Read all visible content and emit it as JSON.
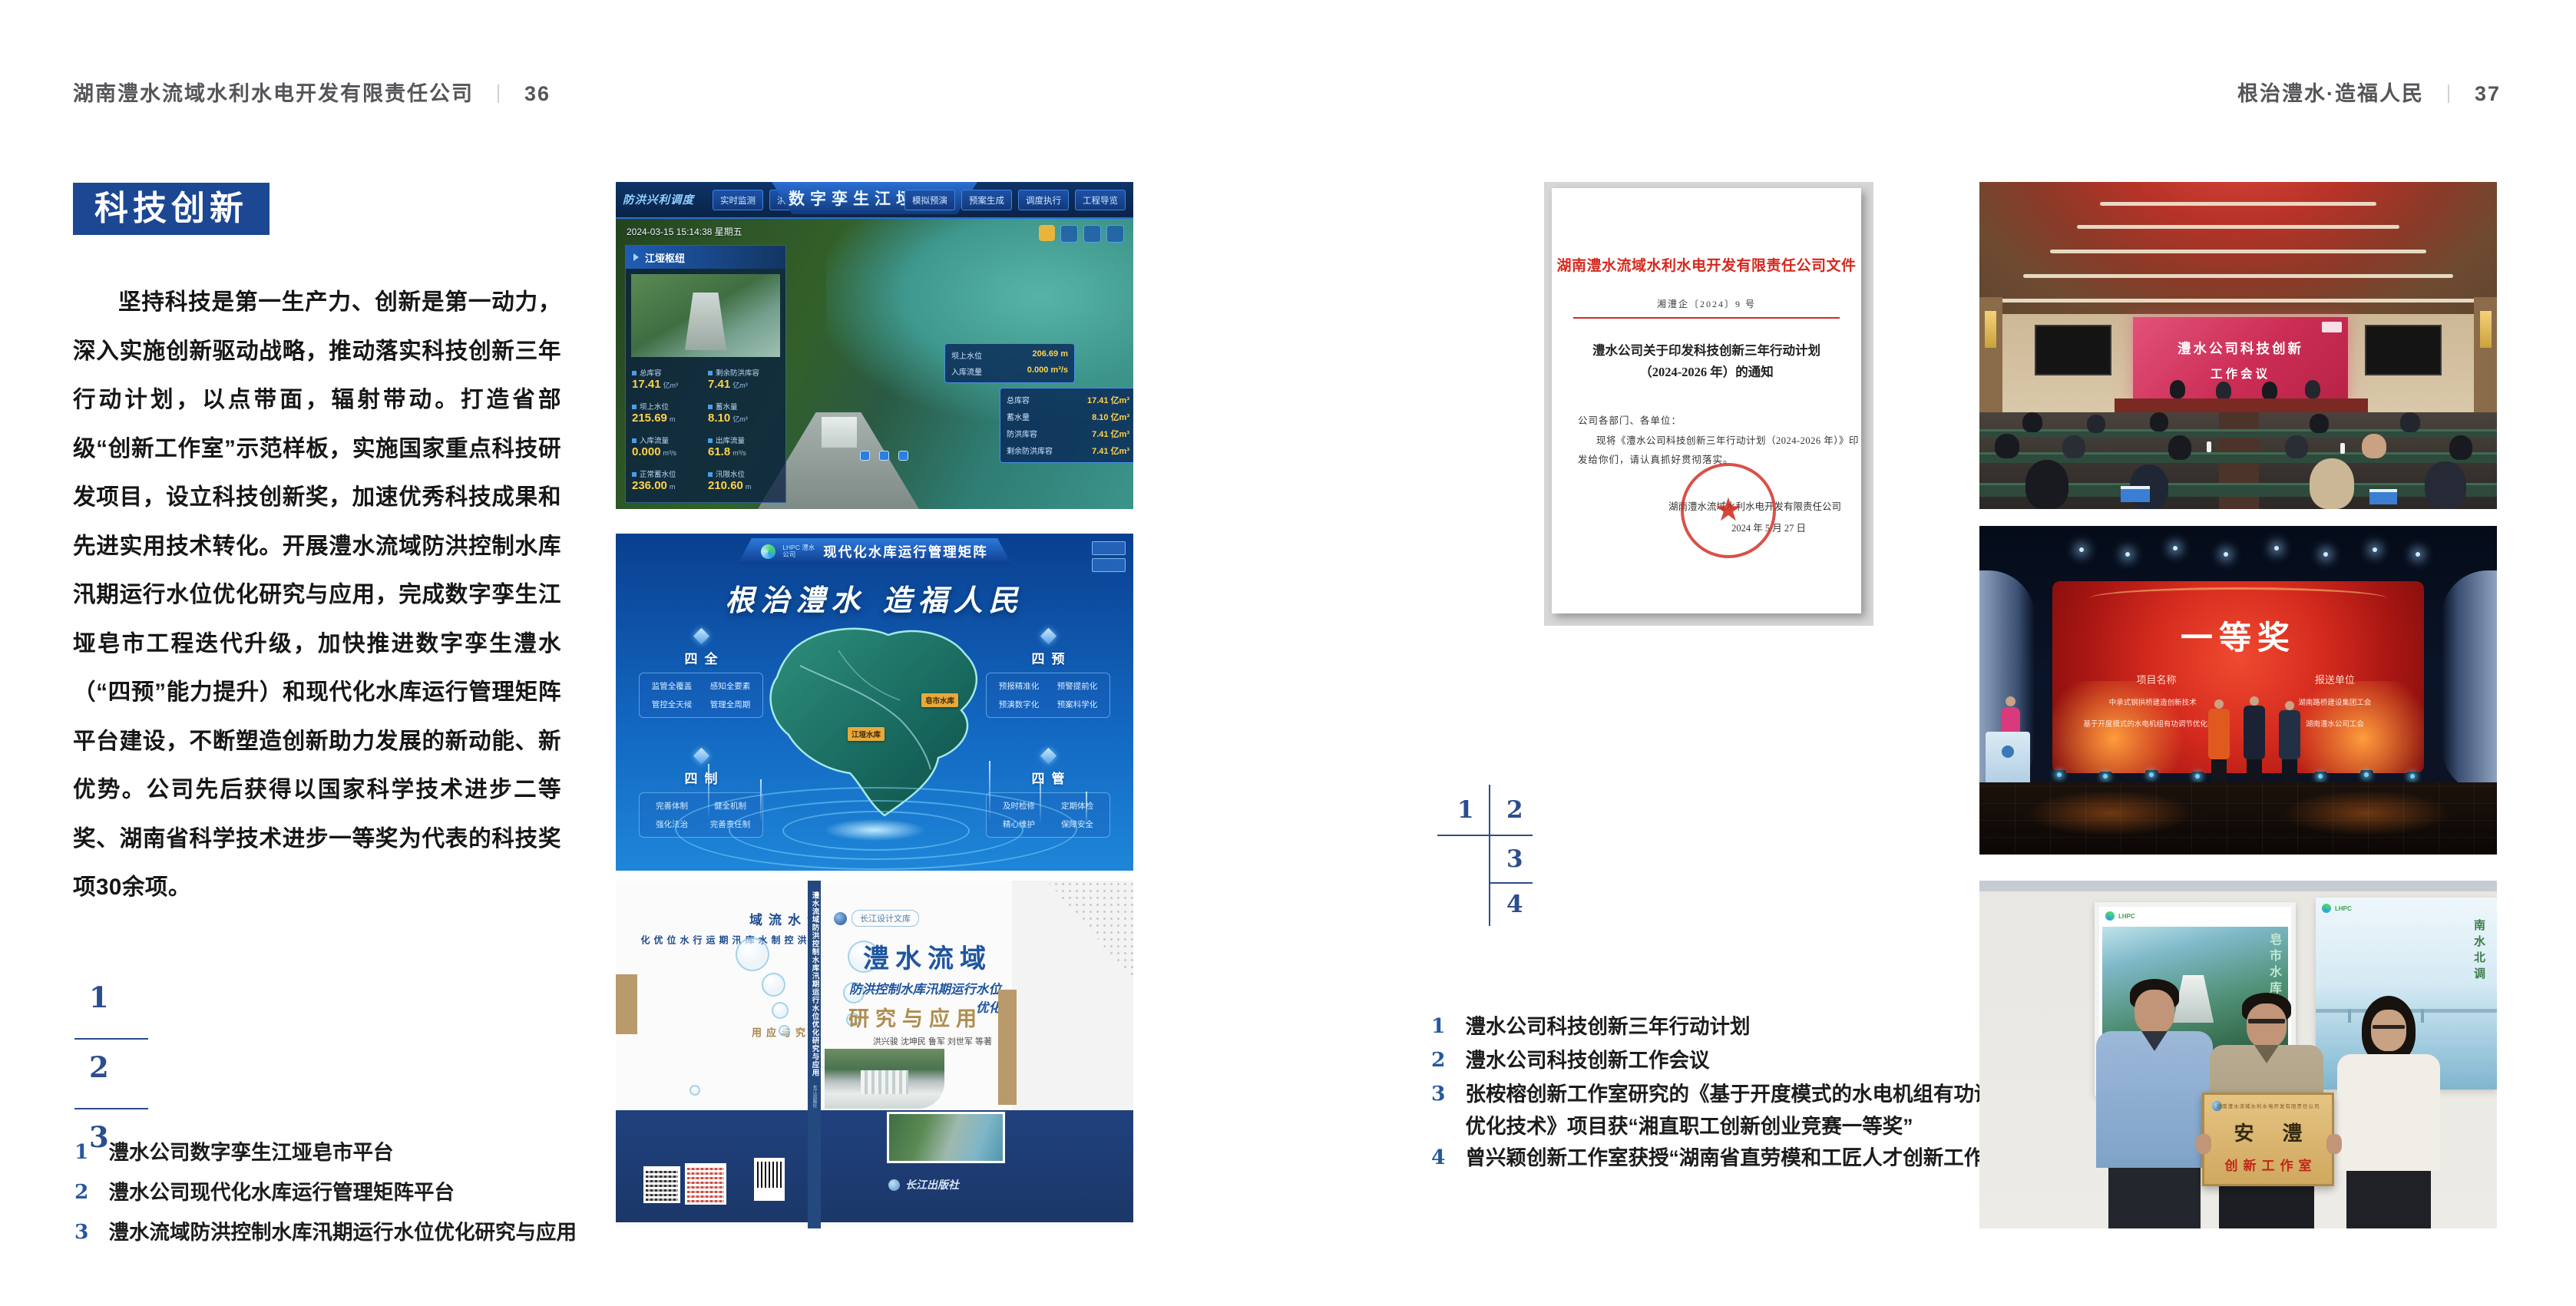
{
  "left_page": {
    "header": {
      "company": "湖南澧水流域水利水电开发有限责任公司",
      "divider": "｜",
      "page_no": "36"
    },
    "badge": "科技创新",
    "paragraph": "坚持科技是第一生产力、创新是第一动力，深入实施创新驱动战略，推动落实科技创新三年行动计划，以点带面，辐射带动。打造省部级“创新工作室”示范样板，实施国家重点科技研发项目，设立科技创新奖，加速优秀科技成果和先进实用技术转化。开展澧水流域防洪控制水库汛期运行水位优化研究与应用，完成数字孪生江垭皂市工程迭代升级，加快推进数字孪生澧水（“四预”能力提升）和现代化水库运行管理矩阵平台建设，不断塑造创新助力发展的新动能、新优势。公司先后获得以国家科学技术进步二等奖、湖南省科学技术进步一等奖为代表的科技奖项30余项。",
    "markers": [
      "1",
      "2",
      "3"
    ],
    "captions": [
      {
        "no": "1",
        "text": "澧水公司数字孪生江垭皂市平台"
      },
      {
        "no": "2",
        "text": "澧水公司现代化水库运行管理矩阵平台"
      },
      {
        "no": "3",
        "text": "澧水流域防洪控制水库汛期运行水位优化研究与应用"
      }
    ],
    "fig_digital_twin": {
      "nav_group": "防洪兴利调度",
      "tabs_left": [
        "实时监测",
        "洪水预报",
        "防汛预警"
      ],
      "title": "数字孪生江垭皂市",
      "tabs_right": [
        "模拟预演",
        "预案生成",
        "调度执行",
        "工程导览"
      ],
      "timestamp": "2024-03-15 15:14:38 星期五",
      "panel_title": "江垭枢纽",
      "stats": [
        {
          "label": "总库容",
          "value": "17.41",
          "unit": "亿m³"
        },
        {
          "label": "剩余防洪库容",
          "value": "7.41",
          "unit": "亿m³"
        },
        {
          "label": "坝上水位",
          "value": "215.69",
          "unit": "m"
        },
        {
          "label": "蓄水量",
          "value": "8.10",
          "unit": "亿m³"
        },
        {
          "label": "入库流量",
          "value": "0.000",
          "unit": "m³/s"
        },
        {
          "label": "出库流量",
          "value": "61.8",
          "unit": "m³/s"
        },
        {
          "label": "正常蓄水位",
          "value": "236.00",
          "unit": "m"
        },
        {
          "label": "汛限水位",
          "value": "210.60",
          "unit": "m"
        }
      ],
      "popup1": [
        {
          "label": "坝上水位",
          "value": "206.69 m"
        },
        {
          "label": "入库流量",
          "value": "0.000 m³/s"
        }
      ],
      "popup2": [
        {
          "label": "总库容",
          "value": "17.41 亿m³"
        },
        {
          "label": "蓄水量",
          "value": "8.10 亿m³"
        },
        {
          "label": "防洪库容",
          "value": "7.41 亿m³"
        },
        {
          "label": "剩余防洪库容",
          "value": "7.41 亿m³"
        }
      ]
    },
    "fig_matrix": {
      "logo": "LHPC 澧水公司",
      "title": "现代化水库运行管理矩阵",
      "slogan": "根治澧水 造福人民",
      "groups": [
        {
          "name": "四全",
          "items": [
            "监管全覆盖",
            "感知全要素",
            "管控全天候",
            "管理全周期"
          ]
        },
        {
          "name": "四预",
          "items": [
            "预报精准化",
            "预警提前化",
            "预演数字化",
            "预案科学化"
          ]
        },
        {
          "name": "四制",
          "items": [
            "完善体制",
            "健全机制",
            "强化法治",
            "完善责任制"
          ]
        },
        {
          "name": "四管",
          "items": [
            "及时检修",
            "定期体检",
            "精心维护",
            "保障安全"
          ]
        }
      ],
      "map_labels": [
        "江垭水库",
        "皂市水库"
      ]
    },
    "fig_book": {
      "series_badge": "长江设计文库",
      "title_main": "澧水流域",
      "title_sub": "防洪控制水库汛期运行水位优化",
      "title_tail": "研究与应用",
      "authors": "洪兴骏 沈坤民 鲁军 刘世军 等著",
      "publisher": "长江出版社",
      "spine_text": "澧水流域防洪控制水库汛期运行水位优化研究与应用",
      "back_title_1": "澧水流域",
      "back_title_2": "防洪控制水库汛期运行水位优化",
      "back_title_3": "研究与应用"
    }
  },
  "right_page": {
    "header": {
      "slogan": "根治澧水·造福人民",
      "divider": "｜",
      "page_no": "37"
    },
    "document": {
      "title": "湖南澧水流域水利水电开发有限责任公司文件",
      "doc_number": "湘澧企〔2024〕9 号",
      "subject_line1": "澧水公司关于印发科技创新三年行动计划",
      "subject_line2": "（2024-2026 年）的通知",
      "salutation": "公司各部门、各单位：",
      "body_line1": "现将《澧水公司科技创新三年行动计划（2024-2026 年）》印",
      "body_line2": "发给你们，请认真抓好贯彻落实。",
      "signer": "湖南澧水流域水利水电开发有限责任公司",
      "date": "2024 年 5 月 27 日"
    },
    "markers": [
      "1",
      "2",
      "3",
      "4"
    ],
    "captions": [
      {
        "no": "1",
        "text": "澧水公司科技创新三年行动计划"
      },
      {
        "no": "2",
        "text": "澧水公司科技创新工作会议"
      },
      {
        "no": "3",
        "line1": "张桉榕创新工作室研究的《基于开度模式的水电机组有功调节",
        "line2": "优化技术》项目获“湘直职工创新创业竞赛一等奖”"
      },
      {
        "no": "4",
        "text": "曾兴颖创新工作室获授“湖南省直劳模和工匠人才创新工作室”"
      }
    ],
    "photo_meeting": {
      "screen_line1": "澧水公司科技创新",
      "screen_line2": "工作会议"
    },
    "photo_award": {
      "screen_title": "一等奖",
      "col_project": "项目名称",
      "col_unit": "报送单位",
      "rows": [
        {
          "project": "中承式钢拱桥建造创新技术",
          "unit": "湖南路桥建设集团工会"
        },
        {
          "project": "基于开度模式的水电机组有功调节优化技术",
          "unit": "湖南澧水公司工会"
        }
      ]
    },
    "photo_plaque": {
      "plaque_header": "湖南澧水流域水利水电开发有限责任公司",
      "plaque_name": "安  澧",
      "plaque_title": "创新工作室",
      "poster_left_text": "皂市水库",
      "poster_right_text": "南水北调"
    }
  }
}
